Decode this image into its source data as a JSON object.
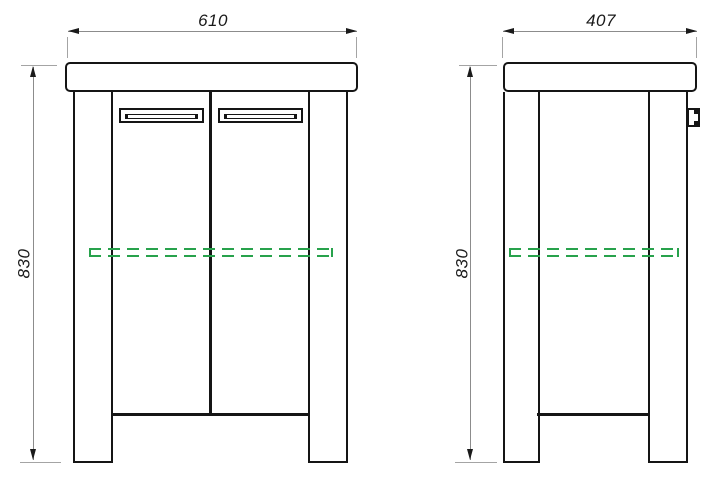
{
  "drawing": {
    "type": "technical-dimension-drawing",
    "subject": "two-door cabinet, front and side elevations",
    "front_view": {
      "name": "front elevation",
      "width_label": "610",
      "height_label": "830"
    },
    "side_view": {
      "name": "side elevation",
      "width_label": "407",
      "height_label": "830"
    },
    "colors": {
      "outline": "#151515",
      "dimension_line": "#8c8c8c",
      "extension_line": "#a4a4a4",
      "dimension_text": "#1a1a1a",
      "shelf_dashed_green": "#28a24c",
      "background": "#ffffff"
    }
  }
}
